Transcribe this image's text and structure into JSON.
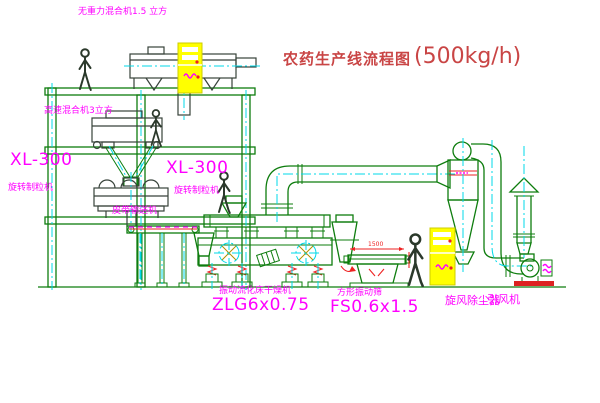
{
  "title": {
    "text": "农药生产线流程图",
    "capacity": "(500kg/h)"
  },
  "equipment_labels": {
    "top_mixer": {
      "name": "无重力混合机1.5 立方"
    },
    "floor2_mixer": {
      "name": "高速混合机3立方"
    },
    "granulator_left": {
      "model": "XL-300",
      "name": "旋转制粒机"
    },
    "granulator_right": {
      "model": "XL-300",
      "name": "旋转制粒机"
    },
    "belt_conveyor": {
      "name": "皮带输送机"
    },
    "fluid_bed_dryer": {
      "name": "振动流化床干燥机",
      "model": "ZLG6x0.75"
    },
    "vibrating_screen": {
      "name": "方形振动筛",
      "model": "FS0.6x1.5",
      "dimension": "1500"
    },
    "cyclone": {
      "name": "旋风除尘器"
    },
    "fan": {
      "name": "引风机"
    }
  },
  "colors": {
    "background": "#ffffff",
    "line_green": "#0e7d0e",
    "equipment_dark": "#37423a",
    "centerline_cyan": "#00d8e8",
    "label_magenta": "#ff00ff",
    "title_red": "#c94545",
    "cabinet_yellow": "#ffff00",
    "accent_red": "#ee2222"
  },
  "icons": {
    "person_figure": "worker-silhouette",
    "circle_cross_symbol": "blower-circle-crosshair",
    "centerline_style": "cyan-dash-dot"
  }
}
